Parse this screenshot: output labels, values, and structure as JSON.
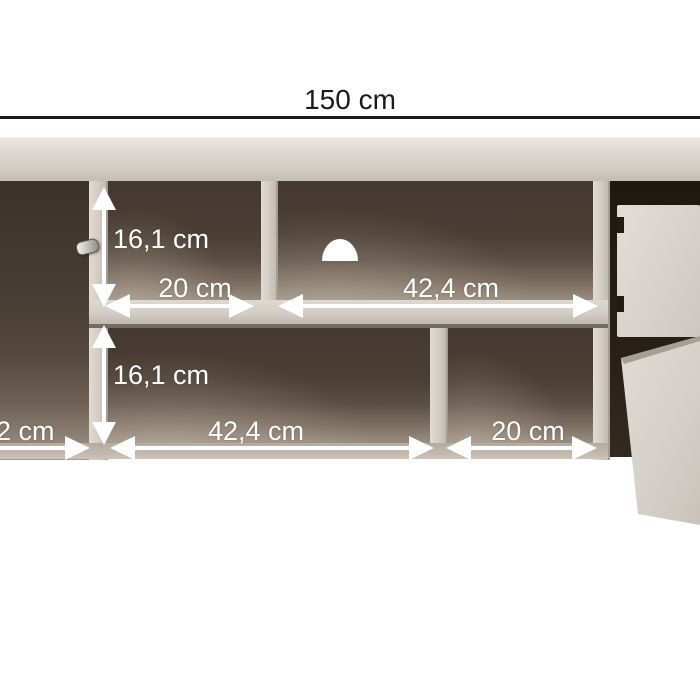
{
  "diagram": {
    "overall_width_label": "150 cm",
    "annotations": {
      "top_row": {
        "shelf_height": "16,1 cm",
        "left_compartment_width": "20 cm",
        "right_compartment_width": "42,4 cm"
      },
      "bottom_row": {
        "shelf_height": "16,1 cm",
        "left_edge_partial": "2 cm",
        "left_compartment_width": "42,4 cm",
        "right_compartment_width": "20 cm"
      }
    },
    "colors": {
      "background": "#ffffff",
      "dimension_line": "#1b1b1b",
      "dimension_text_dark": "#1a1a1a",
      "annotation_white": "#ffffff",
      "panel_light": "#d6d1c9",
      "interior_dark": "#463a31",
      "drawer_bay_dark": "#241c14",
      "floor_light": "#a99d91"
    }
  }
}
